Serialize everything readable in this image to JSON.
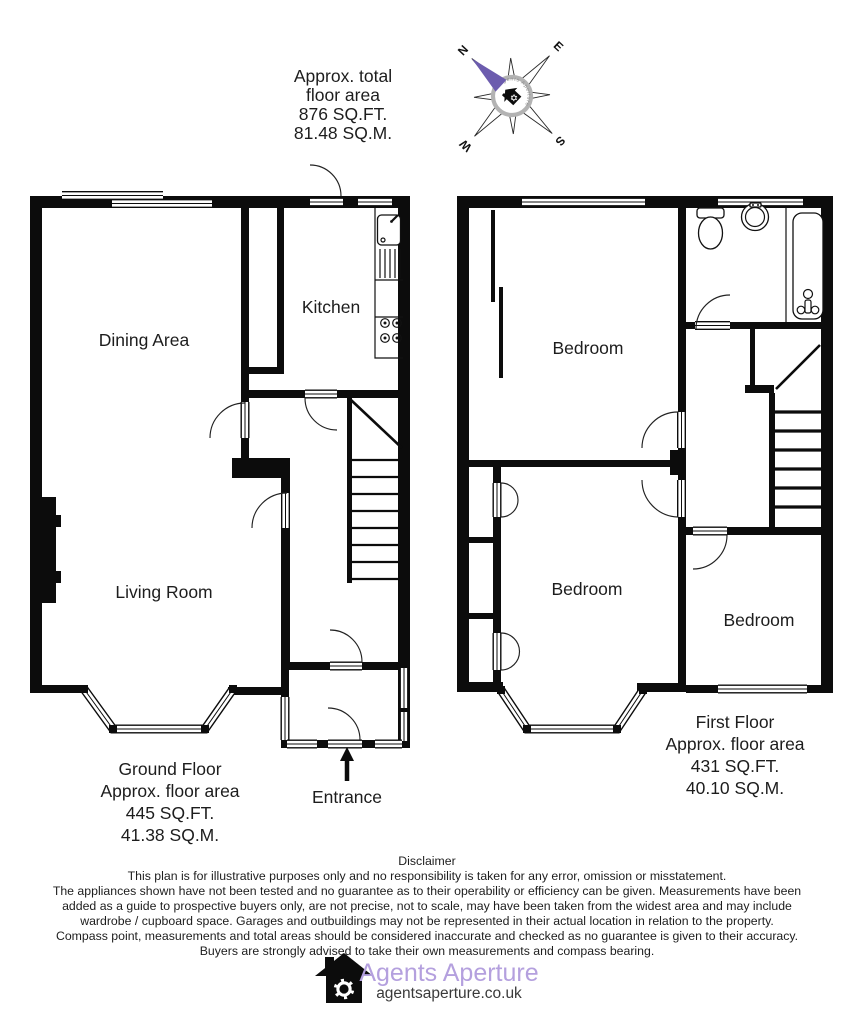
{
  "page": {
    "background": "#ffffff",
    "wall_color": "#0c0c0c"
  },
  "header": {
    "total_area_lines": [
      "Approx. total",
      "floor area",
      "876 SQ.FT.",
      "81.48 SQ.M."
    ]
  },
  "compass": {
    "north": "N",
    "east": "E",
    "south": "S",
    "west": "W",
    "brand": "Agents Aperture",
    "needle_color": "#6c5cae",
    "ring_color": "#b3b3b3"
  },
  "ground_floor": {
    "rooms": {
      "dining": "Dining Area",
      "kitchen": "Kitchen",
      "living": "Living Room"
    },
    "caption_lines": [
      "Ground Floor",
      "Approx. floor area",
      "445 SQ.FT.",
      "41.38 SQ.M."
    ],
    "entrance_label": "Entrance"
  },
  "first_floor": {
    "rooms": {
      "bedroom1": "Bedroom",
      "bedroom2": "Bedroom",
      "bedroom3": "Bedroom"
    },
    "caption_lines": [
      "First Floor",
      "Approx. floor area",
      "431 SQ.FT.",
      "40.10 SQ.M."
    ]
  },
  "disclaimer": {
    "title": "Disclaimer",
    "lines": [
      "This plan is for illustrative purposes only and no responsibility is taken for any error, omission or misstatement.",
      "The appliances shown have not been tested and no guarantee as to their operability or efficiency can be given. Measurements have been",
      "added as a guide to prospective buyers only, are not precise, not to scale, may have been taken from the widest area and may include",
      "wardrobe / cupboard space. Garages and outbuildings may not be represented in their actual location in relation to the property.",
      "Compass point, measurements and total areas should be considered inaccurate and checked as no guarantee is given to their accuracy.",
      "Buyers are strongly advised to take their own measurements and compass bearing."
    ]
  },
  "footer": {
    "brand": "Agents Aperture",
    "website": "agentsaperture.co.uk",
    "brand_color": "#b4a0de",
    "website_color": "#3a3a3a"
  }
}
